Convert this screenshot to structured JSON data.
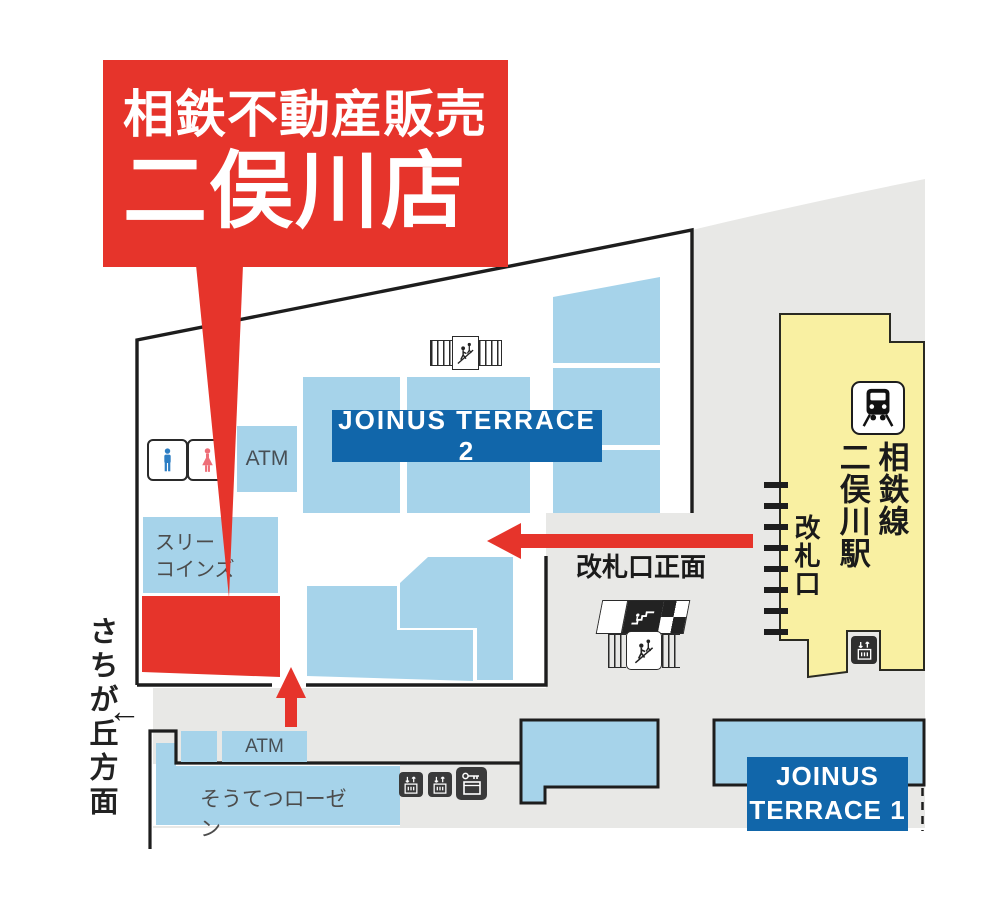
{
  "banner": {
    "line1": "相鉄不動産販売",
    "line2": "二俣川店"
  },
  "buildings": {
    "joinus_terrace_2": "JOINUS TERRACE 2",
    "joinus_terrace_1": [
      "JOINUS",
      "TERRACE 1"
    ]
  },
  "shops": {
    "three_coins": [
      "スリー",
      "コインズ"
    ],
    "rosen": "そうてつローゼン",
    "atm_upper": "ATM",
    "atm_lower": "ATM"
  },
  "station": {
    "line_name": "相鉄線",
    "station_name": "二俣川駅",
    "gate_label": "改札口",
    "gate_front_label": "改札口正面"
  },
  "directions": {
    "sachigaoka": "さちが丘方面",
    "sachigaoka_arrow": "←"
  },
  "icons": [
    "mens-restroom-icon",
    "womens-restroom-icon",
    "stairs-icon",
    "escalator-icon",
    "elevator-icon",
    "coin-locker-icon",
    "train-icon",
    "station-elevator-icon"
  ],
  "colors": {
    "accent_red": "#e6342b",
    "shop_blue": "#a6d3ea",
    "banner_blue": "#1166aa",
    "station_yellow": "#f9f0a2",
    "plaza_gray": "#e8e8e6",
    "line_black": "#1d1d1d",
    "mens_blue": "#2d7ec4",
    "womens_red": "#ee6e78"
  }
}
